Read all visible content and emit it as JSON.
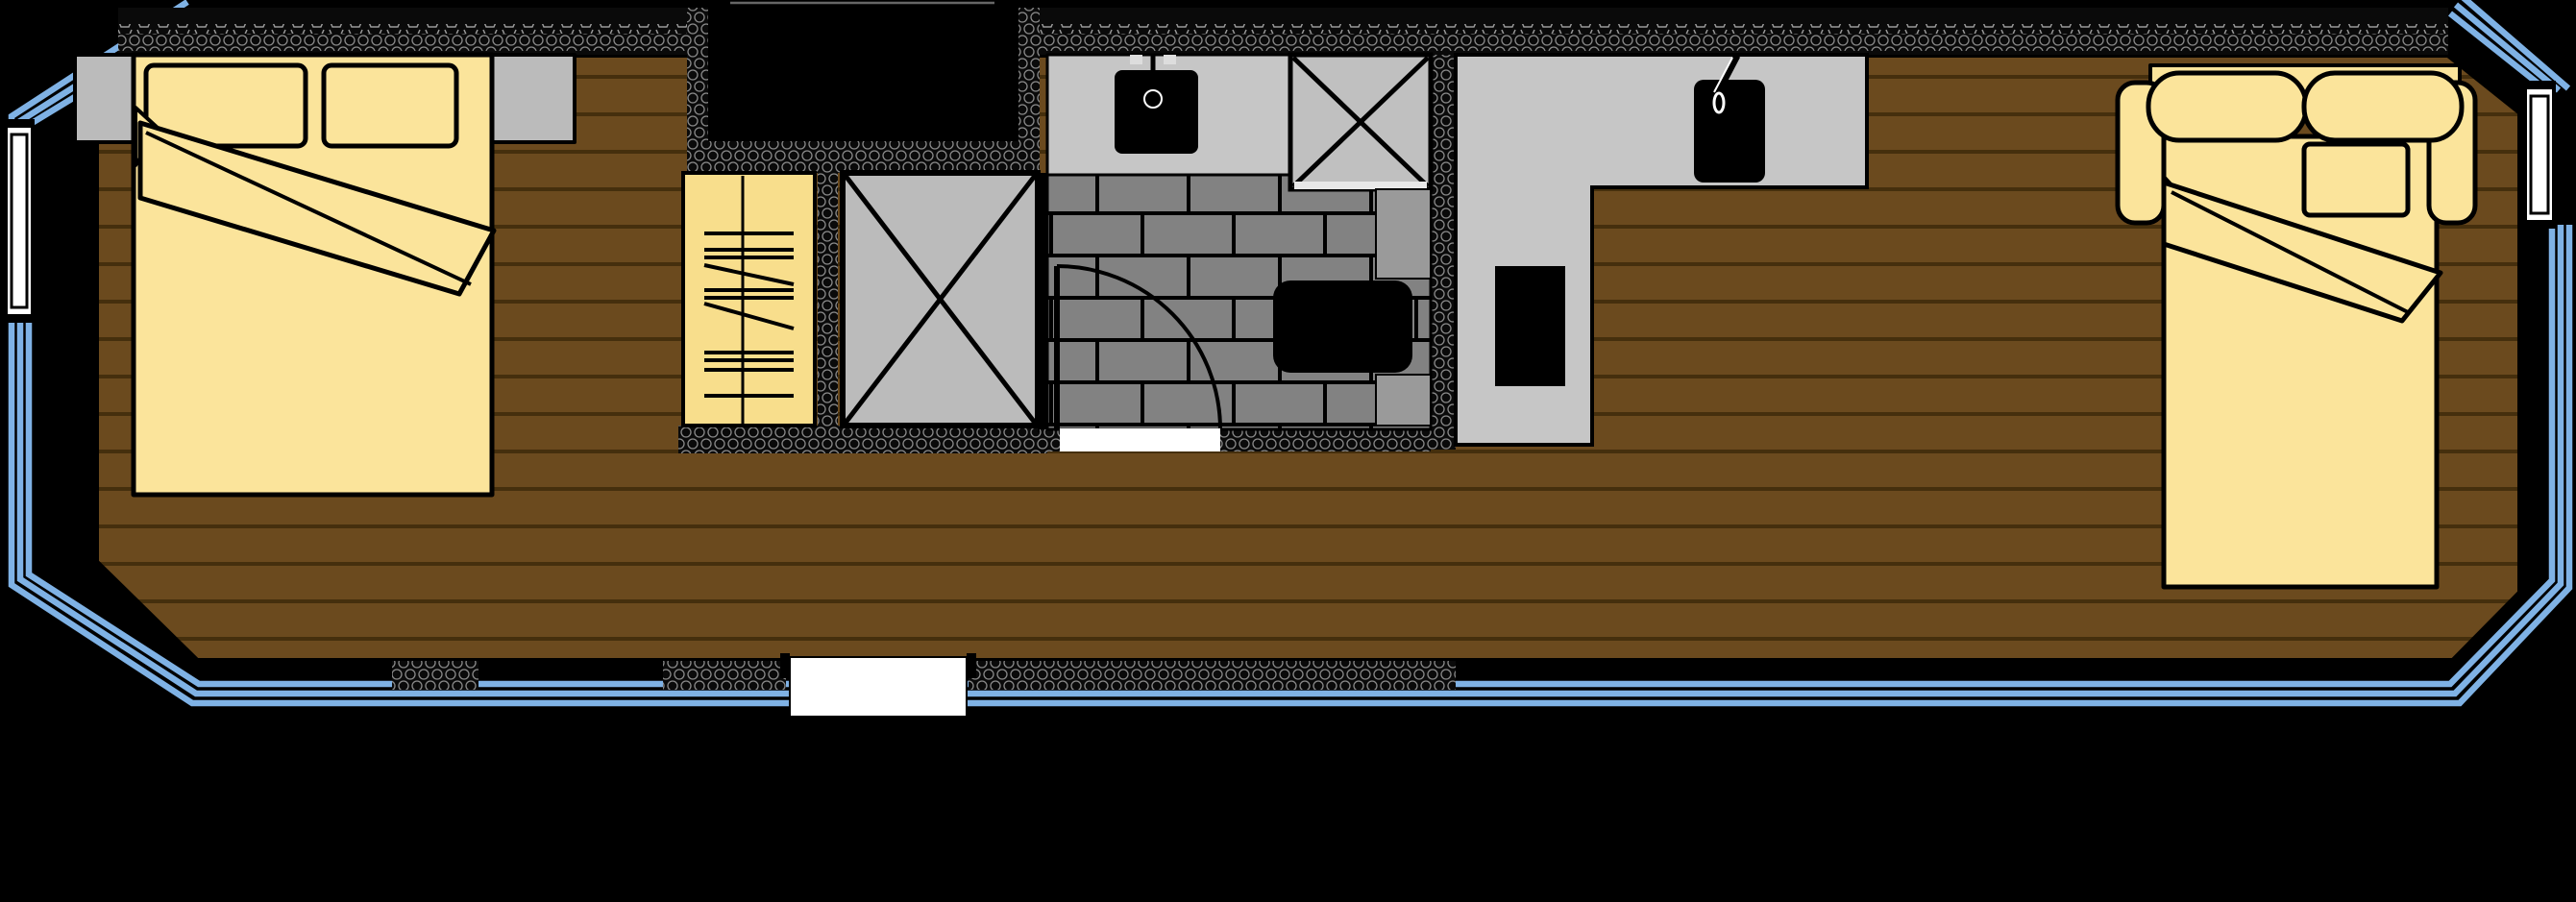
{
  "title": "Narrowboat floor plan (top-down view)",
  "colors": {
    "background": "#000000",
    "hull_blue": "#7FB2E5",
    "wood": "#6B4A1E",
    "wood_line": "#452F0D",
    "bedding": "#FBE49B",
    "wardrobe": "#F8DE8C",
    "furniture_gray": "#BBBBBB",
    "counter_gray": "#C6C6C6",
    "shower_gray": "#C0C0C0",
    "tile_gray": "#828282",
    "cistern_gray": "#9A9A9A",
    "fixture_black": "#000000",
    "wall_base": "#0A0A0A",
    "wall_hatch": "#8A8A8A",
    "white": "#FFFFFF",
    "step_gray": "#666666"
  },
  "plan": {
    "vessel": "narrowboat",
    "view": "top-down floor plan",
    "rooms": [
      {
        "name": "bow-bedroom",
        "fixtures": [
          "double-bed",
          "pillow-left",
          "pillow-right",
          "blanket-fold",
          "nightstand-left",
          "nightstand-right"
        ]
      },
      {
        "name": "entrance-recess",
        "fixtures": [
          "open-step-well"
        ]
      },
      {
        "name": "storage",
        "fixtures": [
          "wardrobe-hanging-rail",
          "crossed-cupboard"
        ]
      },
      {
        "name": "bathroom",
        "fixtures": [
          "vanity-counter",
          "basin",
          "faucet",
          "shower-crossed",
          "toilet",
          "cistern-units",
          "hinged-door",
          "tiled-floor"
        ]
      },
      {
        "name": "kitchen",
        "fixtures": [
          "l-shaped-counter",
          "sink",
          "faucet",
          "cooker"
        ]
      },
      {
        "name": "stern-saloon",
        "fixtures": [
          "sofa-bed",
          "back-cushion-left",
          "back-cushion-right",
          "armrest-left",
          "armrest-right",
          "pillow",
          "blanket-fold"
        ]
      }
    ],
    "openings": [
      "port-bow-window",
      "stern-window",
      "bathroom-side-door",
      "bottom-side-door",
      "bow-entrance-gap"
    ]
  }
}
